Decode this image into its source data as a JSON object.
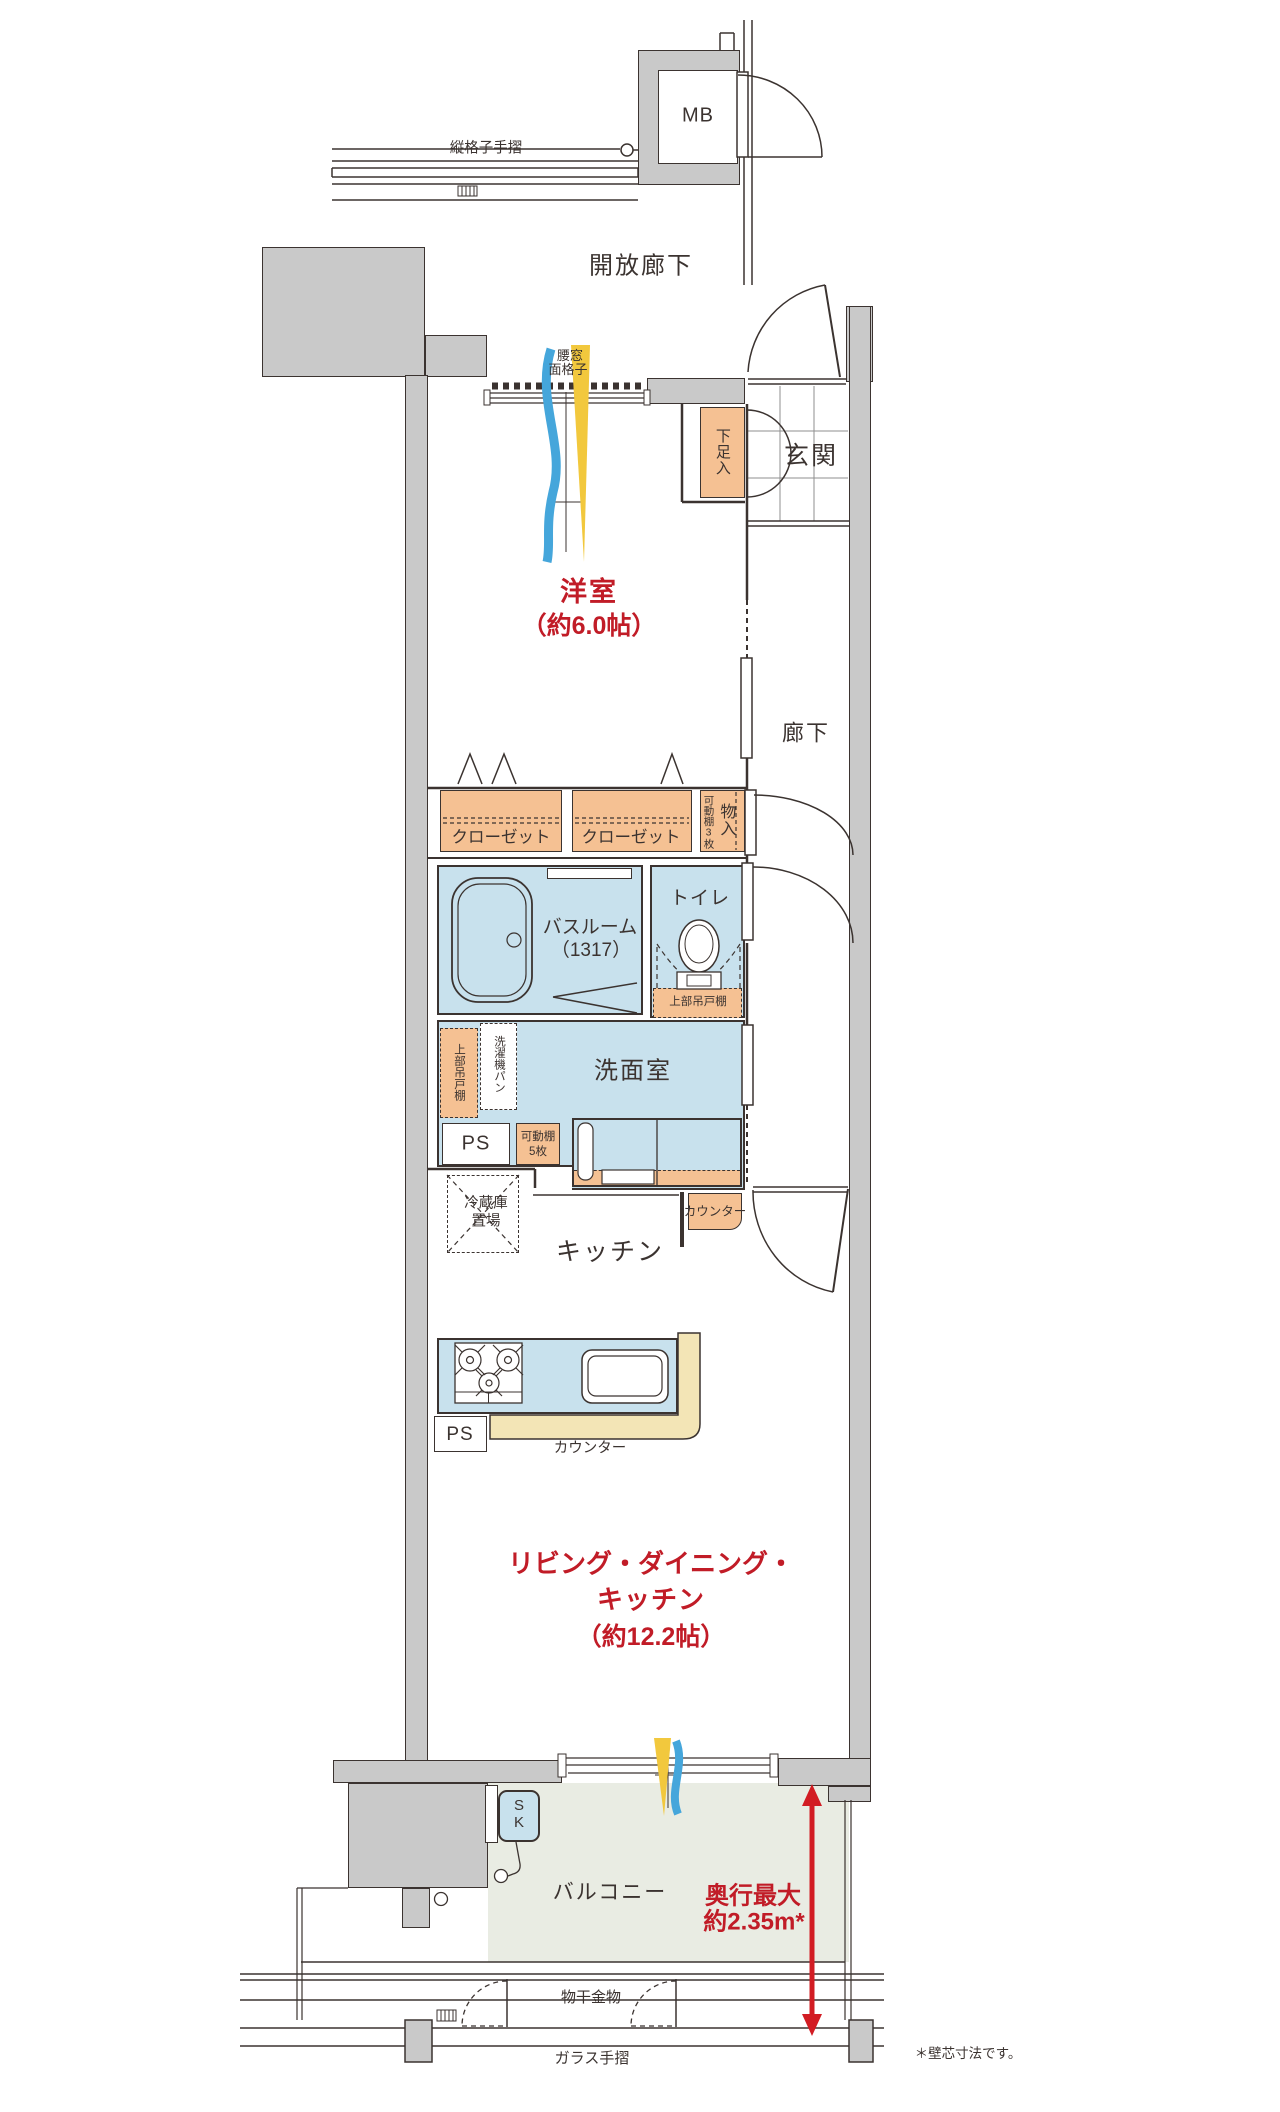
{
  "colors": {
    "wall_gray": "#c9c9c9",
    "room_blue": "#c8e1ed",
    "cabinet_orange": "#f5c193",
    "counter_tan": "#f3e5b6",
    "balcony_floor": "#e9ece3",
    "label_red": "#c11c27",
    "arrow_red": "#d21c23",
    "airflow_blue": "#45a6db",
    "airflow_yellow": "#f2c83d",
    "line": "#3b3330"
  },
  "upper_corridor": {
    "handrail_label": "縦格子手摺",
    "meter_box": "MB",
    "corridor_label": "開放廊下"
  },
  "entry": {
    "window_note_1": "腰窓",
    "window_note_2": "面格子",
    "entrance": "玄関",
    "shoe_cabinet": "下足入"
  },
  "rooms": {
    "western_label": "洋室",
    "western_size": "（約6.0帖）",
    "hallway": "廊下",
    "closet_left": "クローゼット",
    "closet_right": "クローゼット",
    "storage": "物入",
    "storage_shelf": "可動棚3枚",
    "bathroom": "バスルーム",
    "bathroom_size": "（1317）",
    "toilet": "トイレ",
    "toilet_cabinet": "上部吊戸棚",
    "washroom": "洗面室",
    "washroom_cabinet": "上部吊戸棚",
    "washer_pan": "洗濯機パン",
    "ps_upper": "PS",
    "shelf5_1": "可動棚",
    "shelf5_2": "5枚",
    "fridge_1": "冷蔵庫",
    "fridge_2": "置場",
    "kitchen": "キッチン",
    "counter_pass": "カウンター",
    "counter_kitchen": "カウンター",
    "ps_lower": "PS",
    "ldk_1": "リビング・ダイニング・",
    "ldk_2": "キッチン",
    "ldk_3": "（約12.2帖）"
  },
  "balcony": {
    "label": "バルコニー",
    "sink_1": "S",
    "sink_2": "K",
    "depth_1": "奥行最大",
    "depth_2": "約2.35m*",
    "laundry": "物干金物",
    "glass_rail": "ガラス手摺"
  },
  "footnote": "＊壁芯寸法です。"
}
